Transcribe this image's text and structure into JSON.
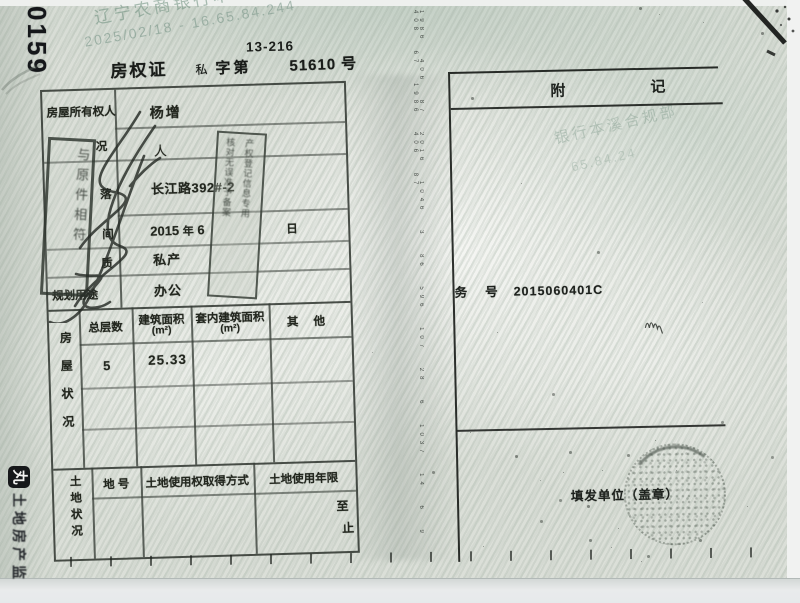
{
  "header": {
    "corner_number": "0159",
    "doc_code": "13-216"
  },
  "watermark": {
    "line1": "辽宁农商银行本溪",
    "line2": "2025/02/18 - 16.65.84.244",
    "right_line1": "银行本溪合规部",
    "right_line2": "65.84.24"
  },
  "title": {
    "name": "房权证",
    "type": "私",
    "zidi": "字第",
    "number": "51610",
    "hao": "号"
  },
  "fields": {
    "owner_label": "房屋所有权人",
    "owner": "杨增",
    "co_label": "况",
    "co_value": "人",
    "loc_label": "落",
    "location": "长江路392#-2",
    "date_label": "间",
    "year": "2015",
    "nian": "年",
    "month": "6",
    "ri": "日",
    "nature_label": "质",
    "nature": "私产",
    "plan_label": "规划用途",
    "plan": "办公"
  },
  "house": {
    "side_label": "房屋状况",
    "h_floors": "总层数",
    "h_area": "建筑面积",
    "h_area_unit": "(m²)",
    "h_inner": "套内建筑面积",
    "h_inner_unit": "(m²)",
    "h_other": "其  他",
    "floors": "5",
    "area": "25.33"
  },
  "land": {
    "side_label": "土地状况",
    "h_landno": "地 号",
    "h_method": "土地使用权取得方式",
    "h_term": "土地使用年限",
    "term_from": "至",
    "term_to": "止"
  },
  "stamps": {
    "verify_stamp": "与原件相符",
    "reg_stamp_line1": "产权登记信息专用",
    "reg_stamp_line2": "核对无误准予备案"
  },
  "appendix": {
    "fu": "附",
    "ji": "记",
    "case_prefix": "务",
    "case_hao": "号",
    "case_number": "2015060401C",
    "issuer": "填发单位（盖章）"
  },
  "edge": {
    "logo_glyph": "丸",
    "label": "土地房产监"
  },
  "fold_marks": "1986 406 87 2016 1046 3 86 596 107 28 6 1037 14 6 9 408 67 1986 406 87",
  "colors": {
    "paper": "#dbdfd8",
    "ink": "#20241f",
    "watermark_green": "#6c8e7c"
  }
}
